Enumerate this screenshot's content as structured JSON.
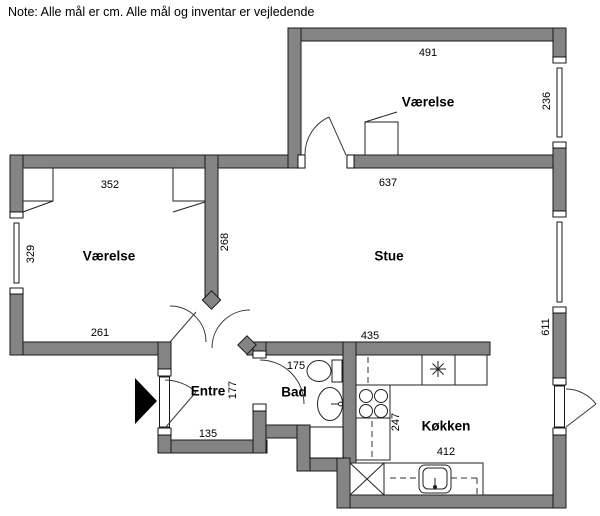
{
  "note": "Note: Alle mål er cm. Alle mål og inventar er vejledende",
  "rooms": {
    "bedroom2": {
      "label": "Værelse",
      "top": "491",
      "right": "236"
    },
    "bedroom1": {
      "label": "Værelse",
      "top": "352",
      "left": "329",
      "bottom": "261"
    },
    "stue": {
      "label": "Stue",
      "top": "637",
      "left": "268",
      "right": "611",
      "bottom": "435"
    },
    "entre": {
      "label": "Entre",
      "depth": "177",
      "width": "135"
    },
    "bad": {
      "label": "Bad",
      "width": "175"
    },
    "kokken": {
      "label": "Køkken",
      "depth": "247",
      "width": "412"
    }
  },
  "colors": {
    "wall": "#848484",
    "outline": "#1a1a1a",
    "background": "#ffffff"
  }
}
